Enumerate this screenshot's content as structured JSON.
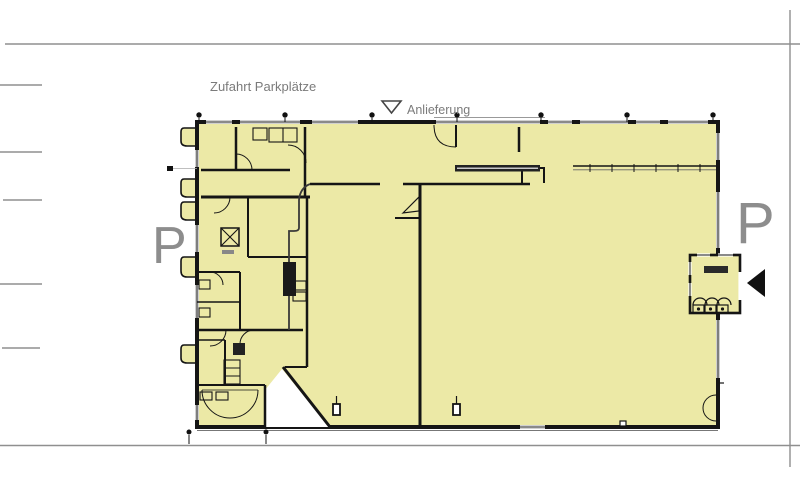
{
  "labels": {
    "zufahrt": "Zufahrt Parkplätze",
    "anlieferung": "Anlieferung",
    "parking_left": "P",
    "parking_right": "P"
  },
  "colors": {
    "background": "#ffffff",
    "room_fill": "#ece9a6",
    "wall": "#151515",
    "site_line": "#8f8f8f",
    "text_gray": "#7b7b7b",
    "parking_letter": "#8d8d8d",
    "entrance_arrow": "#111111",
    "fixture_dark": "#222222"
  },
  "icons": {
    "delivery_direction": "triangle-down-outline-icon",
    "entrance_direction": "triangle-left-filled-icon"
  },
  "grid": {
    "top_marker_count": 7,
    "bottom_marker_count": 2
  }
}
